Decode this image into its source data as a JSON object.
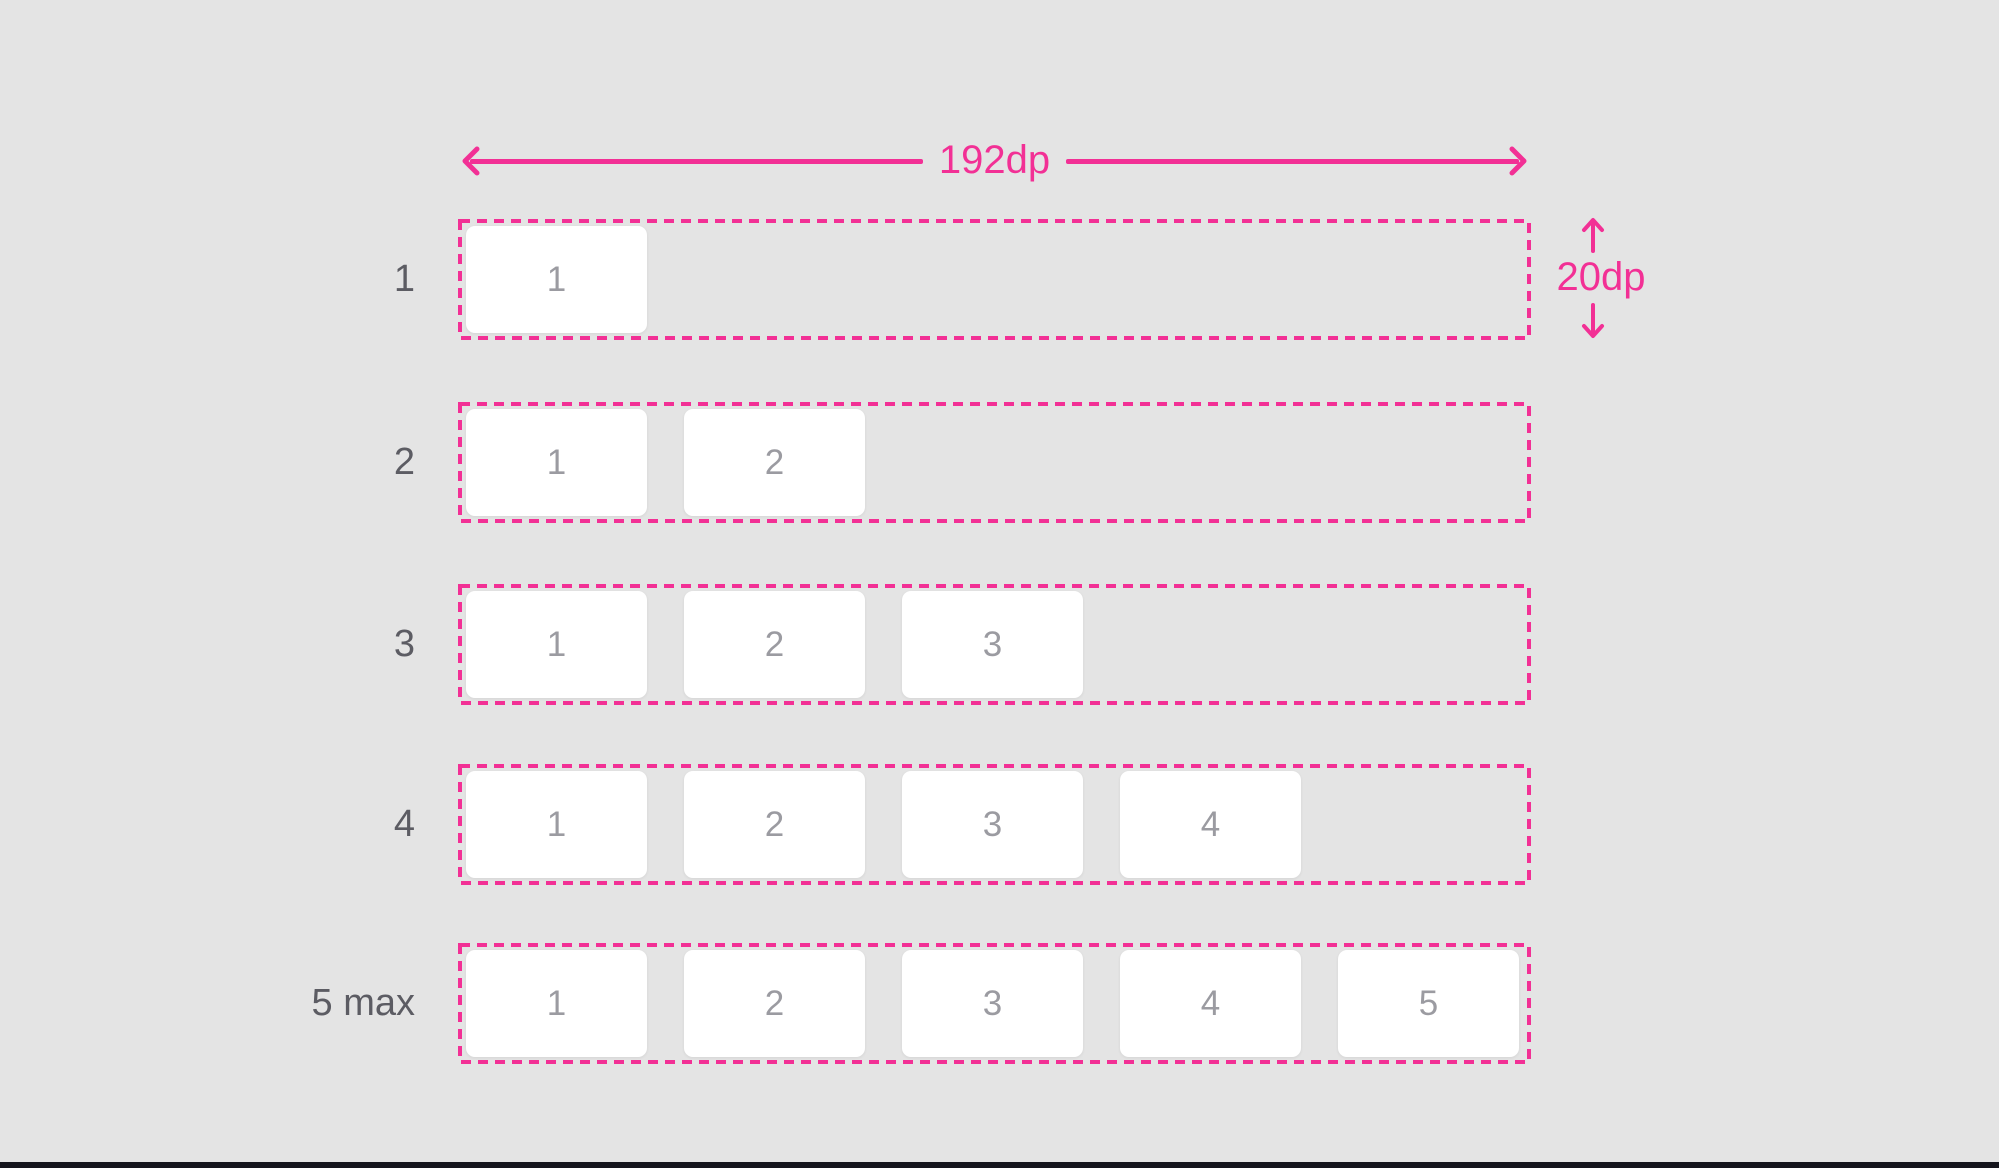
{
  "annotations": {
    "width_label": "192dp",
    "height_label": "20dp"
  },
  "rows": [
    {
      "label": "1",
      "boxes": [
        "1"
      ]
    },
    {
      "label": "2",
      "boxes": [
        "1",
        "2"
      ]
    },
    {
      "label": "3",
      "boxes": [
        "1",
        "2",
        "3"
      ]
    },
    {
      "label": "4",
      "boxes": [
        "1",
        "2",
        "3",
        "4"
      ]
    },
    {
      "label": "5 max",
      "boxes": [
        "1",
        "2",
        "3",
        "4",
        "5"
      ]
    }
  ],
  "colors": {
    "accent": "#F23095",
    "background": "#E4E4E4",
    "box_bg": "#FFFFFF",
    "box_number": "#9B9BA1",
    "row_label": "#5C5C63",
    "bottom_bar": "#15151D"
  }
}
